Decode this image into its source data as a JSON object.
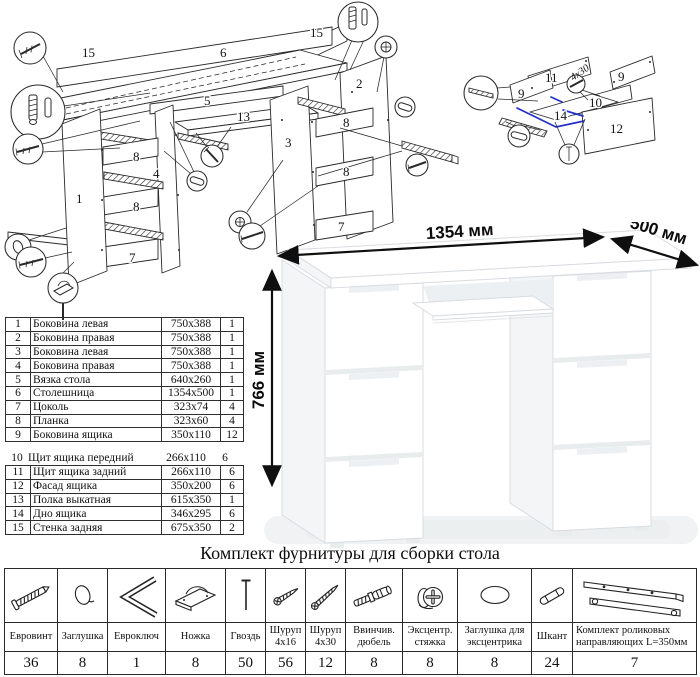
{
  "colors": {
    "ink": "#2a2a2a",
    "accent_blue": "#2130c9",
    "desk_line": "#d8dce0"
  },
  "exploded_main": {
    "labels": {
      "back_panel_a": "15",
      "back_panel_b": "15",
      "desktop": "6",
      "tie": "5",
      "keyboard_shelf": "13",
      "inner_side_right": "3",
      "outer_side_right": "2",
      "outer_side_left": "1",
      "inner_side_left": "4",
      "plank_left_1": "8",
      "plank_left_2": "8",
      "plank_right_1": "8",
      "plank_right_2": "8",
      "plinth_left": "7",
      "plinth_right": "7"
    }
  },
  "exploded_drawer": {
    "labels": {
      "back": "11",
      "side_left": "9",
      "side_right": "9",
      "front": "10",
      "bottom": "14",
      "facade": "12"
    },
    "screw_note": "4x30"
  },
  "desk": {
    "width_label": "1354 мм",
    "depth_label": "500 мм",
    "height_label": "766 мм"
  },
  "parts_table": {
    "rows": [
      {
        "num": "1",
        "name": "Боковина левая",
        "size": "750x388",
        "qty": "1"
      },
      {
        "num": "2",
        "name": "Боковина правая",
        "size": "750x388",
        "qty": "1"
      },
      {
        "num": "3",
        "name": "Боковина левая",
        "size": "750x388",
        "qty": "1"
      },
      {
        "num": "4",
        "name": "Боковина правая",
        "size": "750x388",
        "qty": "1"
      },
      {
        "num": "5",
        "name": "Вязка стола",
        "size": "640x260",
        "qty": "1"
      },
      {
        "num": "6",
        "name": "Столешница",
        "size": "1354x500",
        "qty": "1"
      },
      {
        "num": "7",
        "name": "Цоколь",
        "size": "323x74",
        "qty": "4"
      },
      {
        "num": "8",
        "name": "Планка",
        "size": "323x60",
        "qty": "4"
      },
      {
        "num": "9",
        "name": "Боковина ящика",
        "size": "350x110",
        "qty": "12"
      },
      {
        "num": "10",
        "name": "Щит ящика передний",
        "size": "266x110",
        "qty": "6"
      },
      {
        "num": "11",
        "name": "Щит ящика задний",
        "size": "266x110",
        "qty": "6"
      },
      {
        "num": "12",
        "name": "Фасад ящика",
        "size": "350x200",
        "qty": "6"
      },
      {
        "num": "13",
        "name": "Полка выкатная",
        "size": "615x350",
        "qty": "1"
      },
      {
        "num": "14",
        "name": "Дно ящика",
        "size": "346x295",
        "qty": "6"
      },
      {
        "num": "15",
        "name": "Стенка задняя",
        "size": "675x350",
        "qty": "2"
      }
    ]
  },
  "hardware": {
    "title": "Комплект фурнитуры для сборки стола",
    "items": [
      {
        "name": "Евровинт",
        "qty": "36",
        "icon": "confirmat-screw-icon"
      },
      {
        "name": "Заглушка",
        "qty": "8",
        "icon": "cap-icon"
      },
      {
        "name": "Евроключ",
        "qty": "1",
        "icon": "hex-key-icon"
      },
      {
        "name": "Ножка",
        "qty": "8",
        "icon": "foot-icon"
      },
      {
        "name": "Гвоздь",
        "qty": "50",
        "icon": "nail-icon"
      },
      {
        "name": "Шуруп 4x16",
        "qty": "56",
        "icon": "screw-short-icon"
      },
      {
        "name": "Шуруп 4x30",
        "qty": "12",
        "icon": "screw-long-icon"
      },
      {
        "name": "Ввинчив. дюбель",
        "qty": "8",
        "icon": "threaded-dowel-icon"
      },
      {
        "name": "Эксцентр. стяжка",
        "qty": "8",
        "icon": "cam-lock-icon"
      },
      {
        "name": "Заглушка для эксцентрика",
        "qty": "8",
        "icon": "cam-cap-icon"
      },
      {
        "name": "Шкант",
        "qty": "24",
        "icon": "wood-dowel-icon"
      },
      {
        "name": "Комплект роликовых направляющих L=350мм",
        "qty": "7",
        "icon": "drawer-slide-icon"
      }
    ]
  }
}
